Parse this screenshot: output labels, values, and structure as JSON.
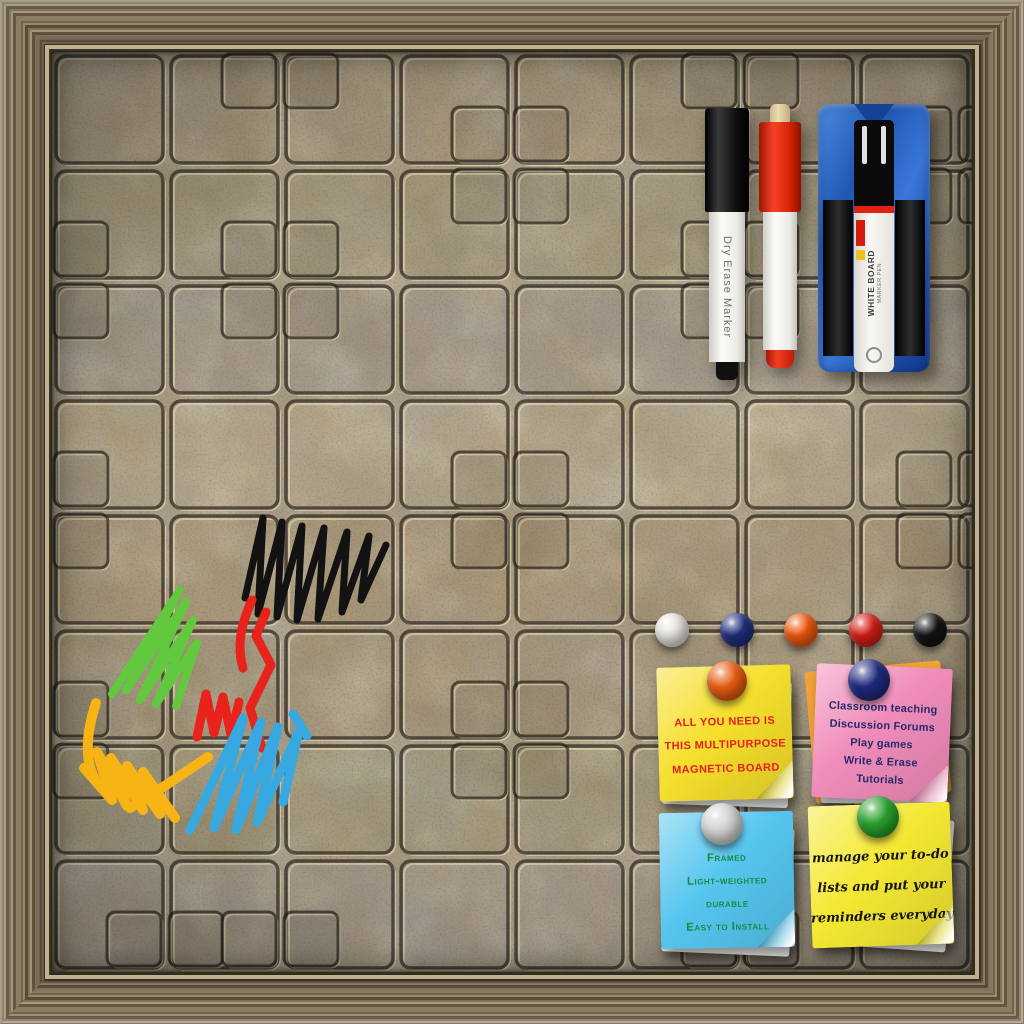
{
  "frame": {
    "wood_color": "#7d7158",
    "lip_color": "#c0b28c"
  },
  "board": {
    "stone_base_color": "#a2957a",
    "groove_dark_color": "#27211a",
    "groove_light_color": "#f4e8c2",
    "palette": {
      "gray_blotch": "#8e8a9e",
      "rust_blotch": "#99662f",
      "olive_blotch": "#70704a",
      "cream_highlight": "#e6d6a8"
    }
  },
  "markers": {
    "black_marker": {
      "label_text": "Dry Erase Marker",
      "cap_color": "#151515",
      "body_color": "#f1efe9"
    },
    "red_marker": {
      "cap_color": "#e52b12",
      "body_color": "#f1efe9",
      "nib_color": "#d9c49a"
    },
    "eraser": {
      "body_color": "#2166cb",
      "pad_color": "#161616",
      "marker": {
        "label_line1": "WHITE BOARD",
        "label_line2": "MARKER PEN",
        "cap_color": "#0b0b0b",
        "band_color": "#e02212",
        "body_color": "#f4f2ec"
      }
    }
  },
  "magnets": [
    {
      "name": "white",
      "color": "#e9e8e4"
    },
    {
      "name": "navy",
      "color": "#20307e"
    },
    {
      "name": "orange",
      "color": "#f25a10"
    },
    {
      "name": "red",
      "color": "#d92019"
    },
    {
      "name": "black",
      "color": "#141414"
    }
  ],
  "scribbles": [
    {
      "name": "black",
      "color": "#121212"
    },
    {
      "name": "green",
      "color": "#62c93e"
    },
    {
      "name": "red",
      "color": "#e8231c"
    },
    {
      "name": "yellow",
      "color": "#f6b514"
    },
    {
      "name": "blue",
      "color": "#38a8e0"
    }
  ],
  "notes": [
    {
      "paper_color": "#f6df2c",
      "ink_color": "#e31f1f",
      "pin_color": "#e85c12",
      "lines": [
        "All you need is",
        "this multipurpose",
        "magnetic board"
      ]
    },
    {
      "paper_color": "#f08cba",
      "ink_color": "#252a6d",
      "pin_color": "#1e2a7e",
      "backing_color": "#f2a238",
      "lines": [
        "Classroom teaching",
        "Discussion Forums",
        "Play games",
        "Write & Erase",
        "Tutorials"
      ]
    },
    {
      "paper_color": "#55c6ef",
      "ink_color": "#1a8a41",
      "pin_color": "#d2d2cf",
      "lines": [
        "Framed",
        "Light-weighted",
        "durable",
        "Easy to Install"
      ]
    },
    {
      "paper_color": "#f4e832",
      "ink_color": "#151310",
      "pin_color": "#27a02c",
      "lines": [
        "manage your to-do",
        "lists and put your",
        "reminders everyday"
      ]
    }
  ]
}
